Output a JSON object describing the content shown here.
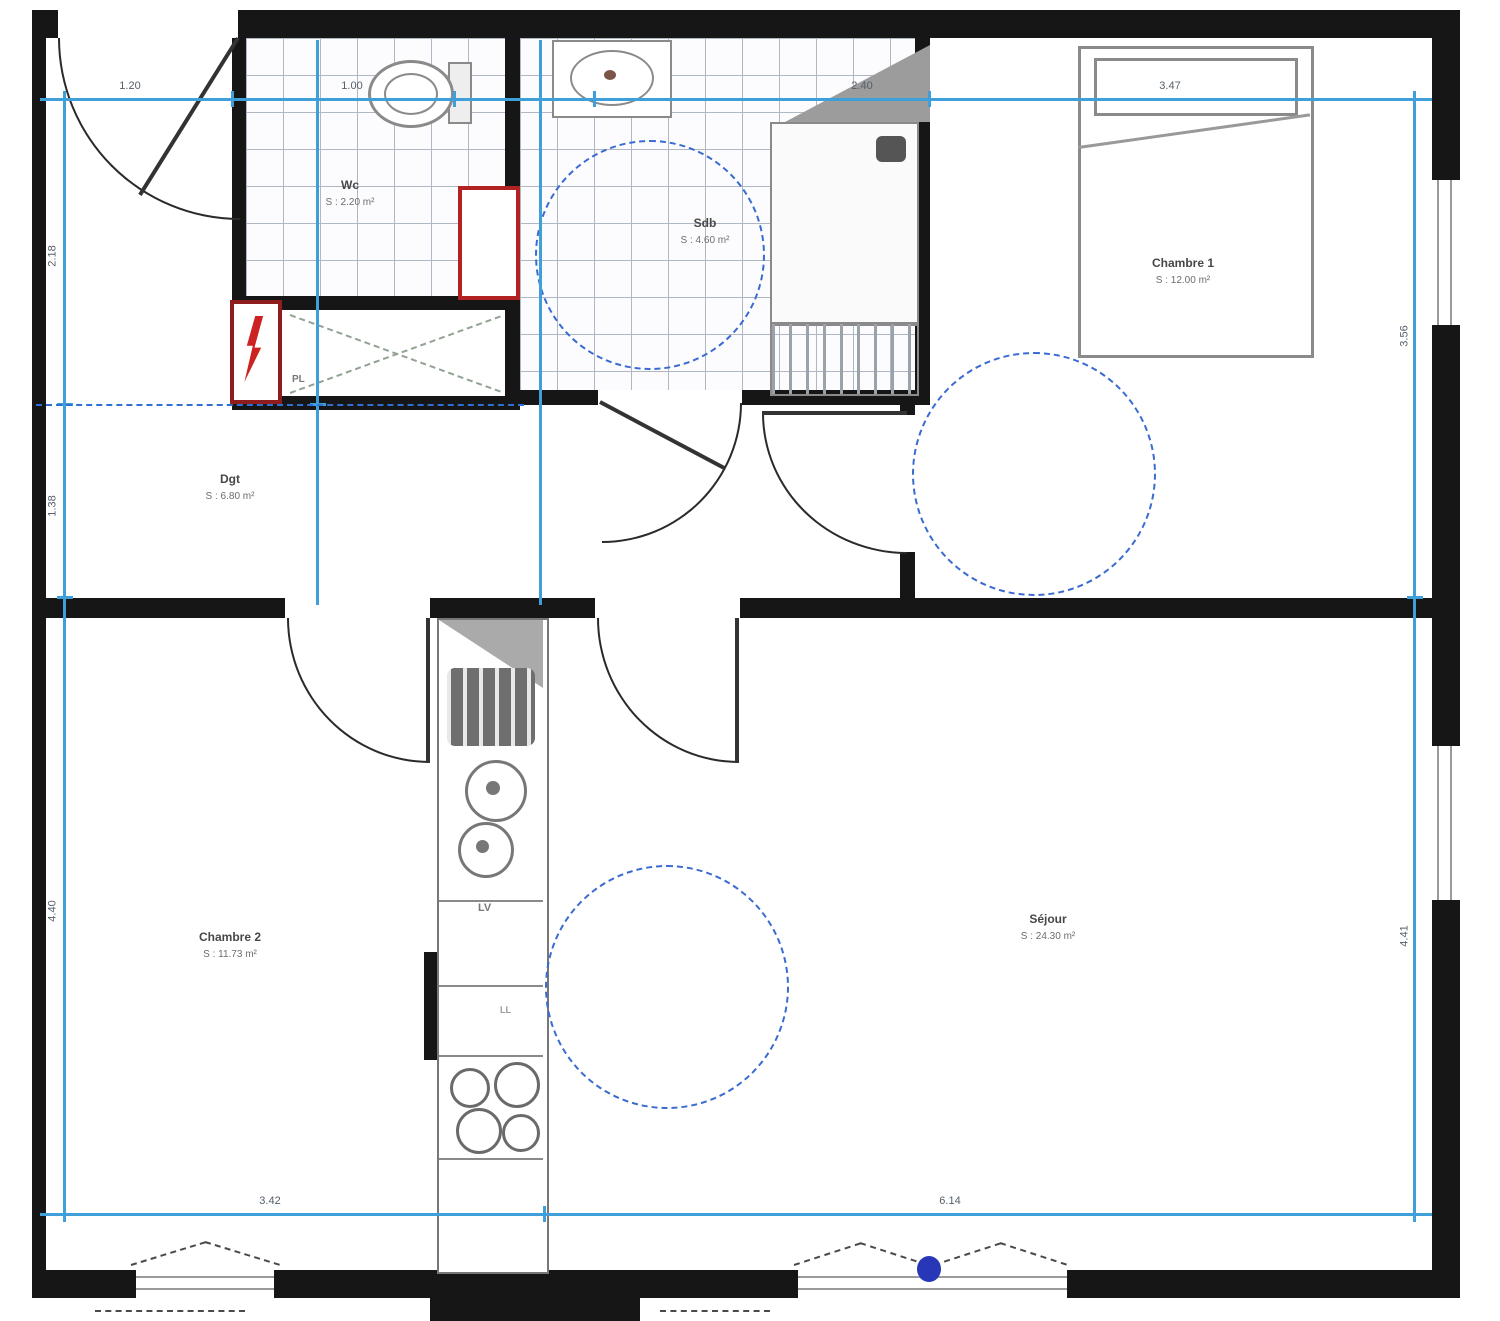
{
  "rooms": {
    "wc": {
      "name": "Wc",
      "area": "S : 2.20 m²"
    },
    "sdb": {
      "name": "Sdb",
      "area": "S : 4.60 m²"
    },
    "dgt": {
      "name": "Dgt",
      "area": "S : 6.80 m²"
    },
    "chambre1": {
      "name": "Chambre 1",
      "area": "S : 12.00 m²"
    },
    "chambre2": {
      "name": "Chambre 2",
      "area": "S : 11.73 m²"
    },
    "sejour": {
      "name": "Séjour",
      "area": "S : 24.30 m²"
    }
  },
  "labels": {
    "closet": "PL",
    "dishwasher": "LV",
    "washing": "LL"
  },
  "dimensions": {
    "top": [
      {
        "label": "1.20"
      },
      {
        "label": "1.00"
      },
      {
        "label": "2.40"
      },
      {
        "label": "3.47"
      }
    ],
    "bottom": [
      {
        "label": "3.42"
      },
      {
        "label": "6.14"
      }
    ],
    "left": [
      {
        "label": "2.18"
      },
      {
        "label": "1.38"
      },
      {
        "label": "4.40"
      }
    ],
    "right": [
      {
        "label": "3.56"
      },
      {
        "label": "4.41"
      }
    ]
  },
  "colors": {
    "wall": "#161616",
    "dimension_line": "#3f9fd8",
    "turning_circle_dashed": "#3a6bd0",
    "alert_red": "#b22222",
    "tile_line": "#aeb7c3",
    "furniture_line": "#8a8a8a",
    "window_marker_blue": "#2737b8"
  }
}
